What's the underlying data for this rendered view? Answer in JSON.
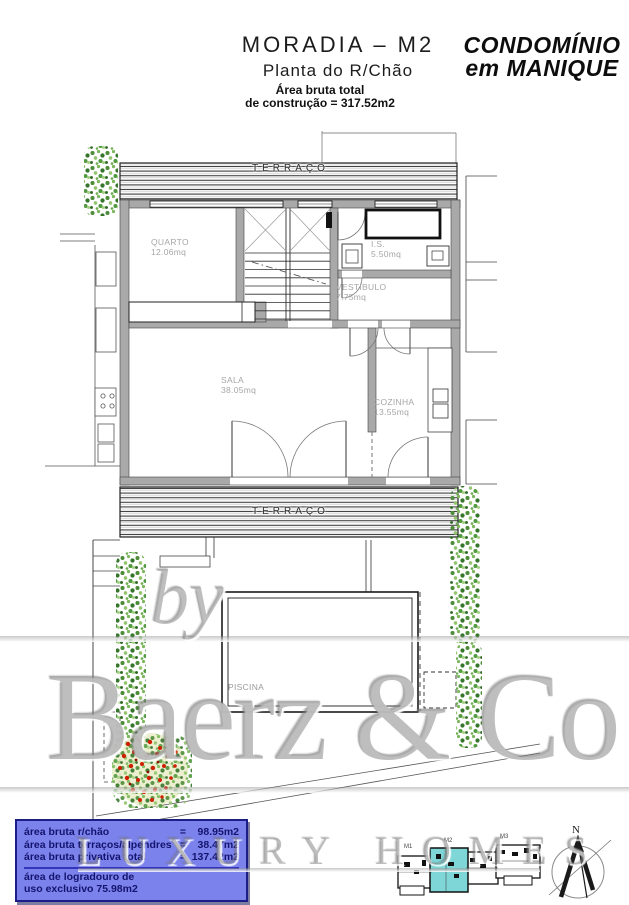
{
  "header": {
    "title": "MORADIA – M2",
    "subtitle": "Planta do R/Chão",
    "area_total_line1": "Área bruta total",
    "area_total_line2": "de construção = 317.52m2"
  },
  "brand": {
    "line1": "CONDOMÍNIO",
    "line2": "em MANIQUE"
  },
  "floorplan": {
    "terrace_top_label": "TERRAÇO",
    "terrace_bottom_label": "TERRAÇO",
    "pool_label": "PISCINA",
    "rooms": [
      {
        "name": "QUARTO",
        "area": "12.06mq"
      },
      {
        "name": "I.S.",
        "area": "5.50mq"
      },
      {
        "name": "VESTÍBULO",
        "area": "7.75mq"
      },
      {
        "name": "SALA",
        "area": "38.05mq"
      },
      {
        "name": "COZINHA",
        "area": "13.55mq"
      }
    ],
    "wall_color": "#a9a9a9",
    "foliage_greens": [
      "#4d8c38",
      "#7cb85c",
      "#35762b",
      "#93c46e"
    ],
    "flower_red": "#cf1f00"
  },
  "watermark": {
    "prefix": "by",
    "brand": "Baerz & Co",
    "tagline": "LUXURY HOMES"
  },
  "info_box": {
    "bg_color": "#7b82ec",
    "border_color": "#1d1d86",
    "text_color": "#14146e",
    "rows": [
      {
        "label": "área bruta r/chão",
        "eq": "=",
        "value": "98.95m2"
      },
      {
        "label": "área bruta terraços/alpendres",
        "eq": "=",
        "value": "38.47m2"
      },
      {
        "label": "área bruta privativa total",
        "eq": "=",
        "value": "137.42m2"
      }
    ],
    "footer_line1": "área de logradouro de",
    "footer_line2": "uso exclusivo 75.98m2"
  },
  "site_plan": {
    "unit_labels": [
      "M1",
      "M2",
      "M3"
    ],
    "highlight_color": "#7fd6d6"
  },
  "compass": {
    "north_label": "N"
  }
}
